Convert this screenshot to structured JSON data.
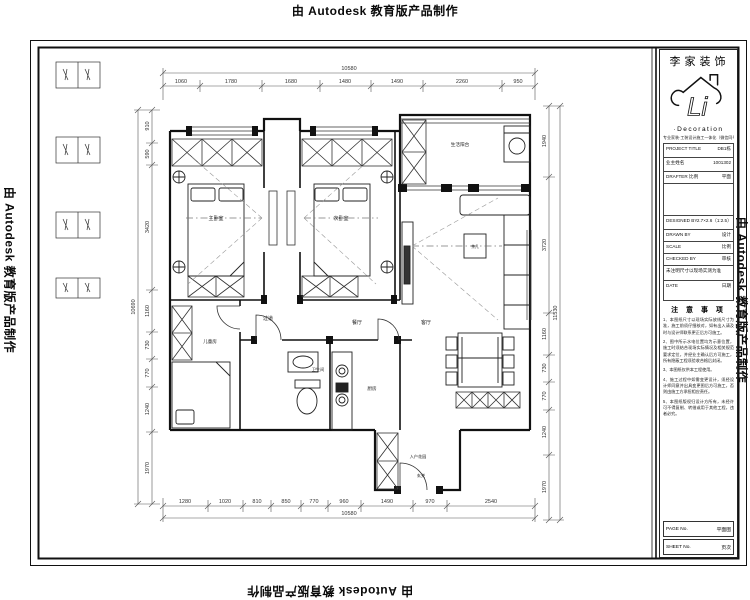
{
  "watermark": {
    "text": "由 Autodesk 教育版产品制作"
  },
  "titleblock": {
    "company": "李家装饰",
    "logo_text": "Li",
    "logo_subtitle": "·Decoration",
    "tagline": "专业家装·工装设计施工一体化（微信同号）",
    "fields": [
      {
        "label": "PROJECT TITLE",
        "value": "DB1栋"
      },
      {
        "label": "业主姓名",
        "value": "1001302"
      },
      {
        "label": "DRAFTER 比例",
        "value": "平面"
      },
      {
        "label": "",
        "value": ""
      },
      {
        "label": "DESIGNED BY",
        "value": "2.7×2.6（1:2.5）"
      },
      {
        "label": "DRAWN BY",
        "value": "设计"
      },
      {
        "label": "SCALE",
        "value": "比例"
      },
      {
        "label": "CHECKED BY",
        "value": "审核"
      },
      {
        "label": "未注明尺寸以现场实测为准",
        "value": ""
      },
      {
        "label": "DATE",
        "value": "日期"
      }
    ],
    "notes_title": "注 意 事 项",
    "notes": [
      "1、本图纸尺寸以现场实际放线尺寸为准，施工前须仔细核对，如有出入请及时与设计师联系更正后方可施工。",
      "2、图中所示水电位置均为示意位置，施工时须结合现场实际情况及相关规范要求定位，并经业主确认后方可施工，所有隐蔽工程须验收合格后封闭。",
      "3、本图纸仅供本工程使用。",
      "4、施工过程中如需变更设计，须经设计师同意并出具变更图后方可施工，否则由施工方承担相应责任。",
      "5、本图纸版权归设计方所有，未经许可不得复制、转借或用于其他工程，违者必究。"
    ],
    "footer": [
      {
        "label": "PAGE No.",
        "value": "平面图"
      },
      {
        "label": "SHEET No.",
        "value": "页次"
      }
    ]
  },
  "rooms": {
    "master_bedroom": "主卧室",
    "second_bedroom": "次卧室",
    "kids_room": "儿童房",
    "balcony": "生活阳台",
    "corridor": "过道",
    "dining": "餐厅",
    "living": "客厅",
    "bathroom": "卫生间",
    "kitchen": "厨房",
    "entry_garden": "入户花园",
    "foyer": "玄关",
    "coffee_table": "茶几"
  },
  "dims": {
    "top": {
      "total": "10580",
      "segments": [
        "1060",
        "1780",
        "1680",
        "1480",
        "1490",
        "2260",
        "950"
      ]
    },
    "bottom": {
      "total": "10580",
      "segments": [
        "1280",
        "1020",
        "810",
        "850",
        "770",
        "960",
        "1490",
        "970",
        "2540"
      ]
    },
    "left": {
      "total": "10690",
      "segments": [
        "910",
        "590",
        "3420",
        "1160",
        "730",
        "770",
        "1240",
        "1970"
      ]
    },
    "right": {
      "total": "11530",
      "segments": [
        "1940",
        "3720",
        "1160",
        "730",
        "770",
        "1240",
        "1970"
      ]
    }
  }
}
